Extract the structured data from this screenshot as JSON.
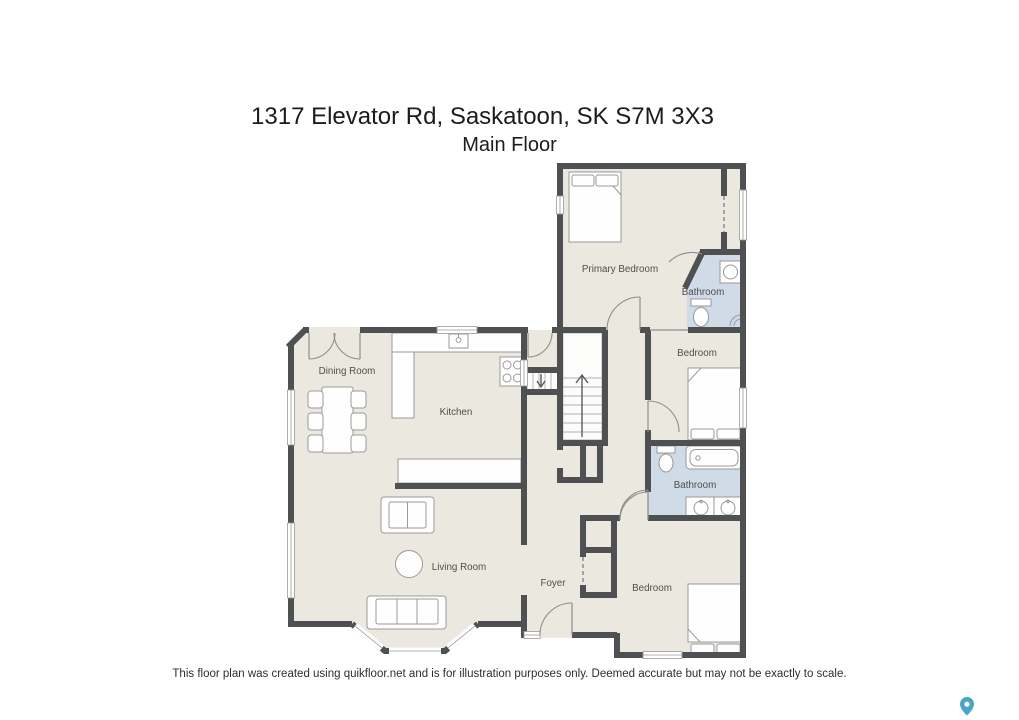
{
  "header": {
    "title": "1317 Elevator Rd, Saskatoon, SK S7M 3X3",
    "subtitle": "Main Floor"
  },
  "plan": {
    "rooms": [
      {
        "id": "primary-bedroom",
        "label": "Primary Bedroom"
      },
      {
        "id": "bathroom-ensuite",
        "label": "Bathroom"
      },
      {
        "id": "bedroom-middle",
        "label": "Bedroom"
      },
      {
        "id": "bathroom-main",
        "label": "Bathroom"
      },
      {
        "id": "bedroom-rear",
        "label": "Bedroom"
      },
      {
        "id": "dining-room",
        "label": "Dining Room"
      },
      {
        "id": "kitchen",
        "label": "Kitchen"
      },
      {
        "id": "living-room",
        "label": "Living Room"
      },
      {
        "id": "foyer",
        "label": "Foyer"
      }
    ]
  },
  "footer": {
    "disclaimer": "This floor plan was created using quikfloor.net and is for illustration purposes only. Deemed accurate but may not be exactly to scale."
  },
  "theme": {
    "page": "#ffffff",
    "title": "#1c1c1c",
    "wall": "#4e5052",
    "floor": "#eae8df",
    "bath": "#cfdbe6",
    "label": "#4f4f4f",
    "fixstroke": "#9a9a9a",
    "pin": "#4aa6c8"
  }
}
